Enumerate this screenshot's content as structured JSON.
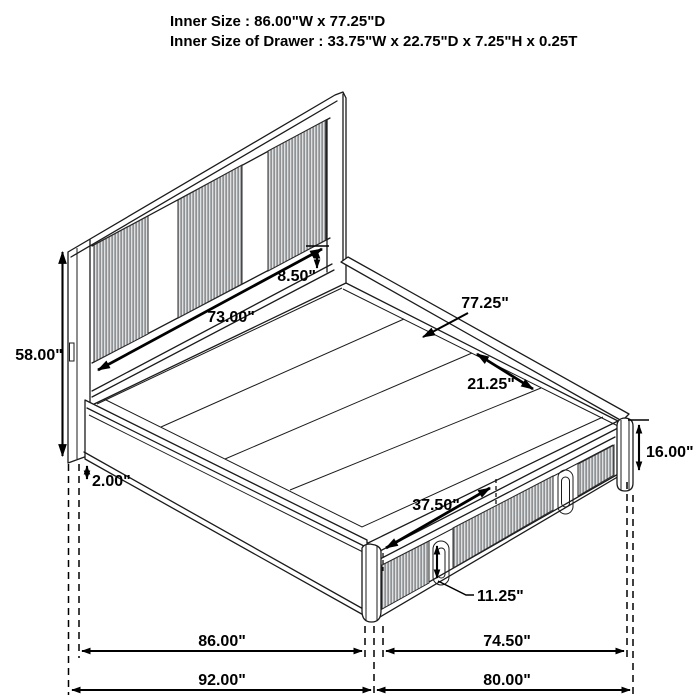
{
  "title_block": {
    "line1": "Inner Size : 86.00\"W x 77.25\"D",
    "line2": "Inner Size of Drawer : 33.75\"W x 22.75\"D x 7.25\"H x 0.25T"
  },
  "dimensions": {
    "headboard_height": "58.00\"",
    "panel_to_deck_gap": "8.50\"",
    "headboard_inner_width": "73.00\"",
    "deck_depth": "77.25\"",
    "slat_width": "21.25\"",
    "base_height": "16.00\"",
    "leg_height": "2.00\"",
    "drawer_front_width": "37.50\"",
    "drawer_handle_height": "11.25\"",
    "side_inner_width": "86.00\"",
    "side_outer_width": "92.00\"",
    "foot_inner_width": "74.50\"",
    "foot_outer_width": "80.00\""
  },
  "colors": {
    "line": "#1b1b1b",
    "background": "#ffffff",
    "rib_stripe": "#63676b",
    "rib_base": "#dfe1e2"
  }
}
